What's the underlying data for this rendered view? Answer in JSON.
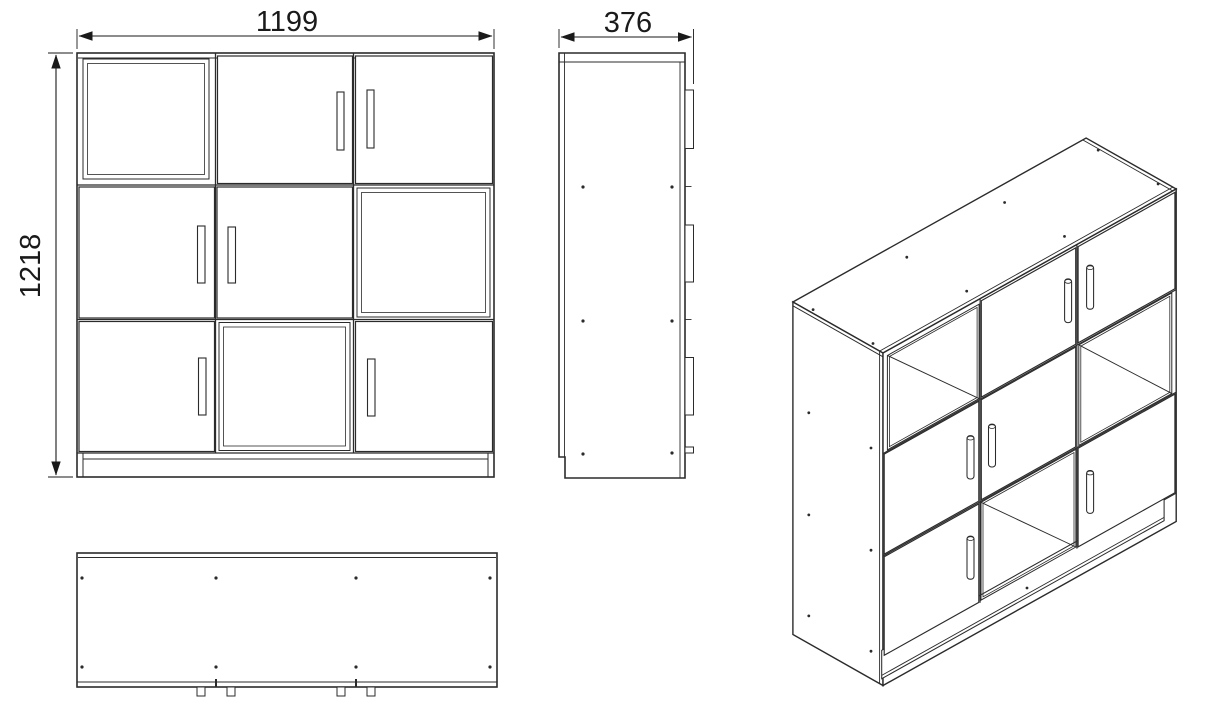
{
  "drawing": {
    "dimensions": {
      "width": "1199",
      "height": "1218",
      "depth": "376"
    },
    "front_view_grid": [
      [
        "open compartment",
        "door handle-right",
        "door handle-left"
      ],
      [
        "door handle-right",
        "door handle-left",
        "open compartment"
      ],
      [
        "door handle-right",
        "open compartment",
        "door handle-left"
      ]
    ],
    "line_color": "#2b2b2b",
    "dim_color": "#1a1a1a",
    "background": "#ffffff"
  }
}
